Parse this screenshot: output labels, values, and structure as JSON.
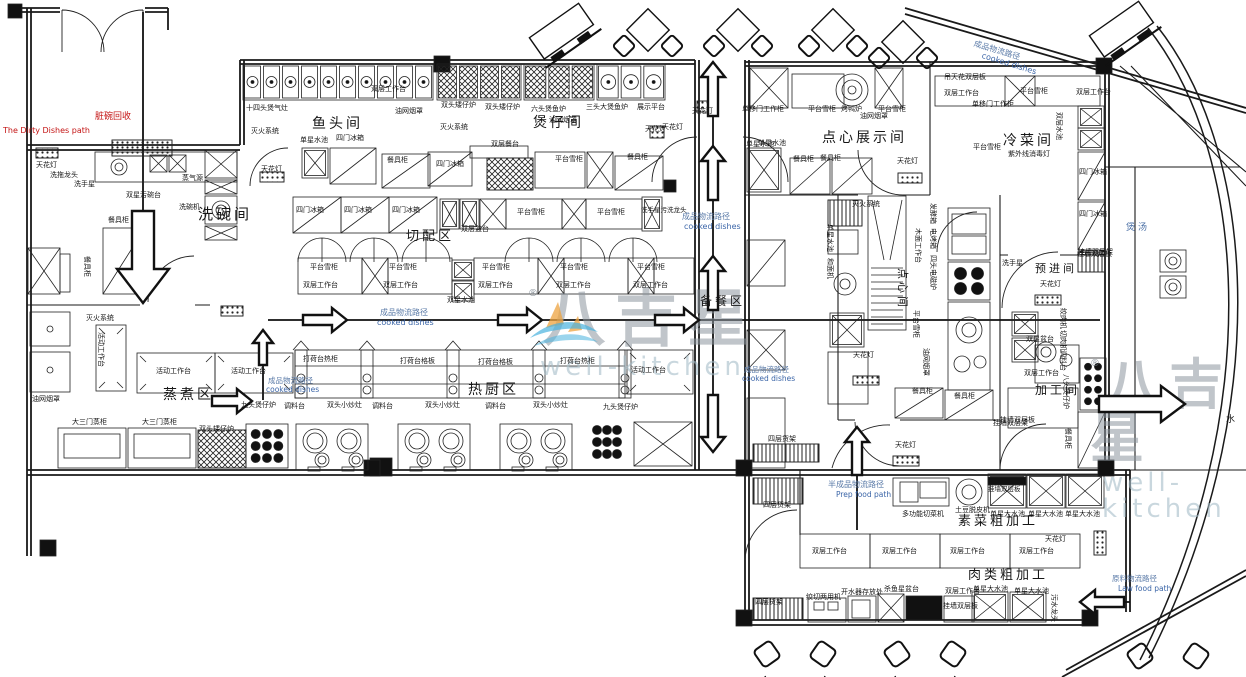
{
  "watermark": {
    "brand": "八吉星",
    "latin": "well-kitchen",
    "registered": "®"
  },
  "colors": {
    "line": "#1a1a1a",
    "flow_text": "#5b7ba8",
    "dirty_path_text": "#c41414",
    "soup_text": "#4a6fa5",
    "watermark_gray": "#8c969e",
    "logo_orange": "#eda33f",
    "logo_blue": "#49b2de"
  },
  "rooms": [
    {
      "t": "洗碗间",
      "x": 198,
      "y": 207,
      "fs": 15
    },
    {
      "t": "鱼头间",
      "x": 312,
      "y": 117,
      "fs": 14
    },
    {
      "t": "煲仔间",
      "x": 533,
      "y": 116,
      "fs": 14
    },
    {
      "t": "切配区",
      "x": 406,
      "y": 230,
      "fs": 13
    },
    {
      "t": "蒸煮区",
      "x": 163,
      "y": 388,
      "fs": 14
    },
    {
      "t": "热厨区",
      "x": 468,
      "y": 383,
      "fs": 14
    },
    {
      "t": "备餐区",
      "x": 700,
      "y": 295,
      "fs": 12
    },
    {
      "t": "点心展示间",
      "x": 822,
      "y": 131,
      "fs": 14
    },
    {
      "t": "冷菜间",
      "x": 1003,
      "y": 134,
      "fs": 14
    },
    {
      "t": "素菜粗加工",
      "x": 958,
      "y": 515,
      "fs": 13
    },
    {
      "t": "肉类粗加工",
      "x": 968,
      "y": 569,
      "fs": 13
    },
    {
      "t": "预进间",
      "x": 1035,
      "y": 263,
      "fs": 11
    },
    {
      "t": "加工间",
      "x": 1035,
      "y": 384,
      "fs": 12
    },
    {
      "t": "点心间",
      "x": 908,
      "y": 268,
      "fs": 11,
      "r": 90
    },
    {
      "t": "煲汤",
      "x": 1126,
      "y": 224,
      "fs": 9,
      "c": "#4a6fa5"
    },
    {
      "t": "水",
      "x": 1226,
      "y": 416,
      "fs": 9
    }
  ],
  "flow_labels": [
    {
      "t": "脏碗回收",
      "x": 95,
      "y": 113,
      "fs": 9,
      "c": "#c41414"
    },
    {
      "t": "The Dirty Dishes path",
      "x": 3,
      "y": 127,
      "fs": 8,
      "c": "#c41414"
    },
    {
      "t": "成品物流路径",
      "x": 682,
      "y": 213,
      "fs": 8,
      "c": "#5b7ba8"
    },
    {
      "t": "cooked dishes",
      "x": 684,
      "y": 223,
      "fs": 8,
      "c": "#3c66a8"
    },
    {
      "t": "成品物流路径",
      "x": 380,
      "y": 309,
      "fs": 8,
      "c": "#5b7ba8"
    },
    {
      "t": "cooked dishes",
      "x": 377,
      "y": 319,
      "fs": 8,
      "c": "#3c66a8"
    },
    {
      "t": "成品物流路径",
      "x": 268,
      "y": 377,
      "fs": 7.5,
      "c": "#5b7ba8"
    },
    {
      "t": "cooked dishes",
      "x": 266,
      "y": 386,
      "fs": 7.5,
      "c": "#3c66a8"
    },
    {
      "t": "成品物流路径",
      "x": 744,
      "y": 366,
      "fs": 7.5,
      "c": "#5b7ba8"
    },
    {
      "t": "cooked dishes",
      "x": 742,
      "y": 375,
      "fs": 7.5,
      "c": "#3c66a8"
    },
    {
      "t": "成品物流路径",
      "x": 975,
      "y": 40,
      "fs": 8,
      "c": "#5b7ba8",
      "r": 17
    },
    {
      "t": "cooked dishes",
      "x": 983,
      "y": 52,
      "fs": 8,
      "c": "#3c66a8",
      "r": 17
    },
    {
      "t": "半成品物流路径",
      "x": 828,
      "y": 481,
      "fs": 8,
      "c": "#5b7ba8"
    },
    {
      "t": "Prep food path",
      "x": 836,
      "y": 491,
      "fs": 7.5,
      "c": "#3c66a8"
    },
    {
      "t": "原料物流路径",
      "x": 1112,
      "y": 575,
      "fs": 7.5,
      "c": "#5b7ba8"
    },
    {
      "t": "Law food path",
      "x": 1118,
      "y": 585,
      "fs": 7.5,
      "c": "#3c66a8"
    }
  ],
  "equipment_labels": [
    {
      "t": "天花灯",
      "x": 36,
      "y": 162
    },
    {
      "t": "洗拖龙头",
      "x": 50,
      "y": 172
    },
    {
      "t": "洗手星",
      "x": 74,
      "y": 181
    },
    {
      "t": "双星污碗台",
      "x": 126,
      "y": 192
    },
    {
      "t": "蒸气源",
      "x": 182,
      "y": 175
    },
    {
      "t": "洗碗机",
      "x": 179,
      "y": 204
    },
    {
      "t": "餐具柜",
      "x": 108,
      "y": 217
    },
    {
      "t": "餐具柜",
      "x": 90,
      "y": 256,
      "r": 90
    },
    {
      "t": "十四头煲气灶",
      "x": 246,
      "y": 105
    },
    {
      "t": "灭火系统",
      "x": 251,
      "y": 128
    },
    {
      "t": "双层工作台",
      "x": 371,
      "y": 86
    },
    {
      "t": "油网烟罩",
      "x": 395,
      "y": 108
    },
    {
      "t": "单星水池",
      "x": 300,
      "y": 137
    },
    {
      "t": "四门冰箱",
      "x": 336,
      "y": 135
    },
    {
      "t": "天花灯",
      "x": 261,
      "y": 166
    },
    {
      "t": "餐具柜",
      "x": 387,
      "y": 157
    },
    {
      "t": "双头矮仔炉",
      "x": 441,
      "y": 102
    },
    {
      "t": "双头矮仔炉",
      "x": 485,
      "y": 104
    },
    {
      "t": "六头煲鱼炉",
      "x": 531,
      "y": 106
    },
    {
      "t": "三头大煲鱼炉",
      "x": 586,
      "y": 104
    },
    {
      "t": "展示平台",
      "x": 637,
      "y": 104
    },
    {
      "t": "油网烟罩",
      "x": 549,
      "y": 117
    },
    {
      "t": "灭火系统",
      "x": 440,
      "y": 124
    },
    {
      "t": "四门冰箱",
      "x": 436,
      "y": 161
    },
    {
      "t": "双层餐台",
      "x": 491,
      "y": 141
    },
    {
      "t": "平台雪柜",
      "x": 555,
      "y": 156
    },
    {
      "t": "餐具柜",
      "x": 627,
      "y": 154
    },
    {
      "t": "天花灯",
      "x": 662,
      "y": 124
    },
    {
      "t": "天花灯",
      "x": 692,
      "y": 108
    },
    {
      "t": "四门冰箱",
      "x": 296,
      "y": 207
    },
    {
      "t": "四门冰箱",
      "x": 344,
      "y": 207
    },
    {
      "t": "四门冰箱",
      "x": 392,
      "y": 207
    },
    {
      "t": "双层盆台",
      "x": 461,
      "y": 226
    },
    {
      "t": "平台雪柜",
      "x": 517,
      "y": 209
    },
    {
      "t": "平台雪柜",
      "x": 597,
      "y": 209
    },
    {
      "t": "洗手星污洗龙头",
      "x": 641,
      "y": 207,
      "fs": 6.5
    },
    {
      "t": "平台雪柜",
      "x": 310,
      "y": 264
    },
    {
      "t": "平台雪柜",
      "x": 389,
      "y": 264
    },
    {
      "t": "平台雪柜",
      "x": 482,
      "y": 264
    },
    {
      "t": "平台雪柜",
      "x": 560,
      "y": 264
    },
    {
      "t": "平台雪柜",
      "x": 637,
      "y": 264
    },
    {
      "t": "双层工作台",
      "x": 303,
      "y": 282
    },
    {
      "t": "双层工作台",
      "x": 383,
      "y": 282
    },
    {
      "t": "双层工作台",
      "x": 478,
      "y": 282
    },
    {
      "t": "双层工作台",
      "x": 556,
      "y": 282
    },
    {
      "t": "双层工作台",
      "x": 633,
      "y": 282
    },
    {
      "t": "双星水池",
      "x": 447,
      "y": 297
    },
    {
      "t": "油网烟罩",
      "x": 32,
      "y": 396
    },
    {
      "t": "灭火系统",
      "x": 86,
      "y": 315
    },
    {
      "t": "活动工作台",
      "x": 104,
      "y": 332,
      "r": 90
    },
    {
      "t": "活动工作台",
      "x": 156,
      "y": 368
    },
    {
      "t": "活动工作台",
      "x": 231,
      "y": 368
    },
    {
      "t": "大三门蒸柜",
      "x": 72,
      "y": 419
    },
    {
      "t": "大三门蒸柜",
      "x": 142,
      "y": 419
    },
    {
      "t": "双头矮仔炉",
      "x": 199,
      "y": 426
    },
    {
      "t": "九头煲仔炉",
      "x": 241,
      "y": 402
    },
    {
      "t": "调料台",
      "x": 284,
      "y": 403
    },
    {
      "t": "双头小炒灶",
      "x": 327,
      "y": 402
    },
    {
      "t": "调料台",
      "x": 372,
      "y": 403
    },
    {
      "t": "双头小炒灶",
      "x": 425,
      "y": 402
    },
    {
      "t": "调料台",
      "x": 485,
      "y": 403
    },
    {
      "t": "双头小炒灶",
      "x": 533,
      "y": 402
    },
    {
      "t": "九头煲仔炉",
      "x": 603,
      "y": 404
    },
    {
      "t": "打荷台热柜",
      "x": 303,
      "y": 356
    },
    {
      "t": "打荷台格板",
      "x": 400,
      "y": 358
    },
    {
      "t": "打荷台格板",
      "x": 478,
      "y": 359
    },
    {
      "t": "打荷台热柜",
      "x": 560,
      "y": 358
    },
    {
      "t": "活动工作台",
      "x": 631,
      "y": 367
    },
    {
      "t": "单移门工作柜",
      "x": 742,
      "y": 106
    },
    {
      "t": "平台雪柜",
      "x": 808,
      "y": 106
    },
    {
      "t": "烤鸭炉",
      "x": 841,
      "y": 106
    },
    {
      "t": "油网烟罩",
      "x": 860,
      "y": 113
    },
    {
      "t": "平台雪柜",
      "x": 878,
      "y": 106
    },
    {
      "t": "单星水池",
      "x": 746,
      "y": 141
    },
    {
      "t": "餐具柜",
      "x": 793,
      "y": 156
    },
    {
      "t": "餐具柜",
      "x": 820,
      "y": 155
    },
    {
      "t": "天花灯",
      "x": 897,
      "y": 158
    },
    {
      "t": "灭火系统",
      "x": 852,
      "y": 201
    },
    {
      "t": "吊天花双层板",
      "x": 944,
      "y": 74
    },
    {
      "t": "双层工作台",
      "x": 944,
      "y": 90
    },
    {
      "t": "单移门工作柜",
      "x": 972,
      "y": 101
    },
    {
      "t": "平台雪柜",
      "x": 1020,
      "y": 88
    },
    {
      "t": "双层工作台",
      "x": 1076,
      "y": 89
    },
    {
      "t": "双层水池",
      "x": 1062,
      "y": 112,
      "r": 90
    },
    {
      "t": "平台雪柜",
      "x": 973,
      "y": 144
    },
    {
      "t": "紫外线消毒灯",
      "x": 1008,
      "y": 151
    },
    {
      "t": "四门冰箱",
      "x": 1079,
      "y": 169
    },
    {
      "t": "四门冰箱",
      "x": 1079,
      "y": 211
    },
    {
      "t": "挂墙双层架",
      "x": 1078,
      "y": 249
    },
    {
      "t": "天花灯",
      "x": 853,
      "y": 352
    },
    {
      "t": "单星水池",
      "x": 833,
      "y": 224,
      "r": 90
    },
    {
      "t": "和面机",
      "x": 833,
      "y": 258,
      "r": 90
    },
    {
      "t": "木面工作台",
      "x": 921,
      "y": 228,
      "r": 90
    },
    {
      "t": "发酵箱",
      "x": 936,
      "y": 203,
      "r": 90
    },
    {
      "t": "电烤箱",
      "x": 936,
      "y": 228,
      "r": 90
    },
    {
      "t": "四头电磁炉",
      "x": 936,
      "y": 255,
      "r": 90
    },
    {
      "t": "平台雪柜",
      "x": 919,
      "y": 310,
      "r": 90
    },
    {
      "t": "油网烟罩",
      "x": 929,
      "y": 348,
      "r": 90
    },
    {
      "t": "餐具柜",
      "x": 912,
      "y": 388
    },
    {
      "t": "餐具柜",
      "x": 954,
      "y": 393
    },
    {
      "t": "洗手星",
      "x": 1002,
      "y": 260
    },
    {
      "t": "天花灯",
      "x": 1040,
      "y": 281
    },
    {
      "t": "双星盆台",
      "x": 1026,
      "y": 336
    },
    {
      "t": "双层工作台",
      "x": 1024,
      "y": 370
    },
    {
      "t": "挂墙双层板",
      "x": 1000,
      "y": 417
    },
    {
      "t": "挂墙双层板",
      "x": 1077,
      "y": 251
    },
    {
      "t": "绞肉机",
      "x": 1066,
      "y": 308,
      "r": 90
    },
    {
      "t": "切肉机",
      "x": 1066,
      "y": 330,
      "r": 90
    },
    {
      "t": "调料台",
      "x": 1066,
      "y": 350,
      "r": 90
    },
    {
      "t": "八头煲仔炉",
      "x": 1069,
      "y": 374,
      "r": 90
    },
    {
      "t": "餐具柜",
      "x": 1071,
      "y": 428,
      "r": 90
    },
    {
      "t": "单星水池",
      "x": 758,
      "y": 140
    },
    {
      "t": "天花灯",
      "x": 645,
      "y": 126
    },
    {
      "t": "四层货架",
      "x": 768,
      "y": 436
    },
    {
      "t": "四层货架",
      "x": 763,
      "y": 502
    },
    {
      "t": "天花灯",
      "x": 895,
      "y": 442
    },
    {
      "t": "天花灯",
      "x": 1045,
      "y": 536
    },
    {
      "t": "多功能切菜机",
      "x": 902,
      "y": 511
    },
    {
      "t": "土豆脱皮机",
      "x": 955,
      "y": 507
    },
    {
      "t": "单星大水池",
      "x": 990,
      "y": 511
    },
    {
      "t": "单星大水池",
      "x": 1028,
      "y": 511
    },
    {
      "t": "单星大水池",
      "x": 1065,
      "y": 511
    },
    {
      "t": "挂墙双层板",
      "x": 988,
      "y": 486,
      "fs": 6.5
    },
    {
      "t": "挂墙双层架",
      "x": 993,
      "y": 420
    },
    {
      "t": "双层工作台",
      "x": 812,
      "y": 548
    },
    {
      "t": "双层工作台",
      "x": 882,
      "y": 548
    },
    {
      "t": "双层工作台",
      "x": 950,
      "y": 548
    },
    {
      "t": "双层工作台",
      "x": 1019,
      "y": 548
    },
    {
      "t": "四层货架",
      "x": 755,
      "y": 599
    },
    {
      "t": "绞切两用机",
      "x": 806,
      "y": 594
    },
    {
      "t": "开水器存放处",
      "x": 841,
      "y": 589
    },
    {
      "t": "杀鱼星盆台",
      "x": 884,
      "y": 586
    },
    {
      "t": "双层工作台",
      "x": 945,
      "y": 588
    },
    {
      "t": "挂墙双层板",
      "x": 943,
      "y": 603
    },
    {
      "t": "单星大水池",
      "x": 973,
      "y": 586
    },
    {
      "t": "单星大水池",
      "x": 1014,
      "y": 588
    },
    {
      "t": "污水龙头",
      "x": 1057,
      "y": 594,
      "r": 90
    }
  ],
  "arrows": [
    {
      "dir": "down",
      "x": 143,
      "y": 303,
      "len": 92,
      "s": 11,
      "h": 26,
      "hl": 34
    },
    {
      "dir": "right",
      "x": 347,
      "y": 320,
      "len": 44
    },
    {
      "dir": "right",
      "x": 542,
      "y": 320,
      "len": 44
    },
    {
      "dir": "right",
      "x": 699,
      "y": 320,
      "len": 44
    },
    {
      "dir": "right",
      "x": 252,
      "y": 401,
      "len": 40
    },
    {
      "dir": "up",
      "x": 713,
      "y": 62,
      "len": 54
    },
    {
      "dir": "up",
      "x": 713,
      "y": 146,
      "len": 54
    },
    {
      "dir": "up",
      "x": 713,
      "y": 256,
      "len": 54
    },
    {
      "dir": "down",
      "x": 713,
      "y": 452,
      "len": 57
    },
    {
      "dir": "up",
      "x": 263,
      "y": 330,
      "len": 35,
      "s": 4,
      "h": 10,
      "hl": 13
    },
    {
      "dir": "up",
      "x": 857,
      "y": 427,
      "len": 48
    },
    {
      "dir": "left",
      "x": 1080,
      "y": 602,
      "len": 44
    },
    {
      "dir": "right",
      "x": 1185,
      "y": 404,
      "len": 86,
      "s": 8,
      "h": 18,
      "hl": 24
    }
  ]
}
